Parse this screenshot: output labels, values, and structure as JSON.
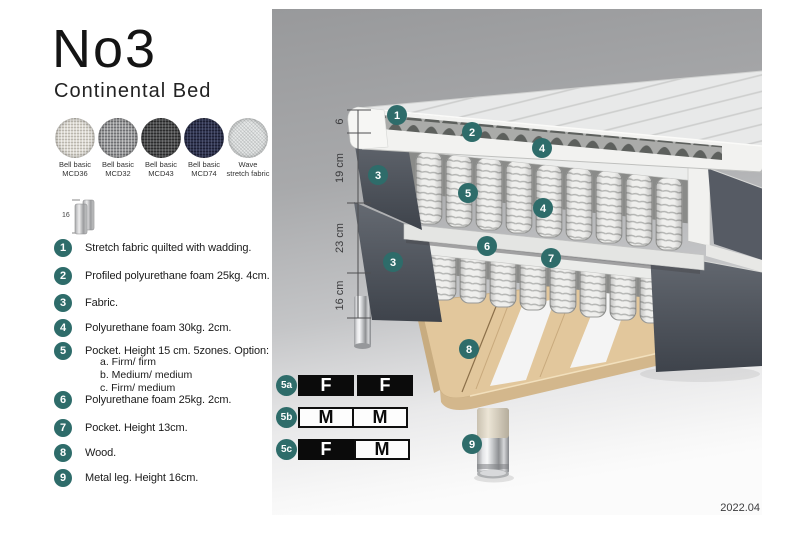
{
  "header": {
    "title": "No3",
    "subtitle": "Continental Bed"
  },
  "swatches": [
    {
      "line1": "Bell basic",
      "line2": "MCD36"
    },
    {
      "line1": "Bell basic",
      "line2": "MCD32"
    },
    {
      "line1": "Bell basic",
      "line2": "MCD43"
    },
    {
      "line1": "Bell basic",
      "line2": "MCD74"
    },
    {
      "line1": "Wave",
      "line2": "stretch fabric"
    }
  ],
  "leg_icon": {
    "label": "16"
  },
  "legend": {
    "items": [
      {
        "num": "1",
        "text": "Stretch fabric quilted with wadding."
      },
      {
        "num": "2",
        "text": "Profiled polyurethane foam 25kg. 4cm."
      },
      {
        "num": "3",
        "text": "Fabric."
      },
      {
        "num": "4",
        "text": "Polyurethane foam 30kg. 2cm."
      },
      {
        "num": "5",
        "text": "Pocket. Height 15 cm. 5zones. Option:"
      },
      {
        "num": "6",
        "text": "Polyurethane foam 25kg. 2cm."
      },
      {
        "num": "7",
        "text": "Pocket. Height 13cm."
      },
      {
        "num": "8",
        "text": "Wood."
      },
      {
        "num": "9",
        "text": "Metal leg. Height 16cm."
      }
    ],
    "options": [
      "a. Firm/ firm",
      "b. Medium/ medium",
      "c. Firm/ medium"
    ]
  },
  "ruler": {
    "labels": [
      "6",
      "19 cm",
      "23 cm",
      "16 cm"
    ]
  },
  "callouts": [
    "1",
    "2",
    "4",
    "3",
    "5",
    "4",
    "6",
    "7",
    "3",
    "8",
    "9"
  ],
  "firmness": {
    "rows": [
      {
        "id": "5a",
        "cells": [
          {
            "label": "F"
          },
          {
            "label": "F"
          }
        ]
      },
      {
        "id": "5b",
        "cells": [
          {
            "label": "M"
          },
          {
            "label": "M"
          }
        ]
      },
      {
        "id": "5c",
        "cells": [
          {
            "label": "F"
          },
          {
            "label": "M"
          }
        ]
      }
    ]
  },
  "footer": {
    "version": "2022.04"
  },
  "colors": {
    "accent_teal": "#2e6c6a",
    "dark_fabric": "#4d525a",
    "wood": "#e2c79c",
    "panel_gray_top": "#98999b",
    "panel_gray_bottom": "#fbfbfb"
  }
}
